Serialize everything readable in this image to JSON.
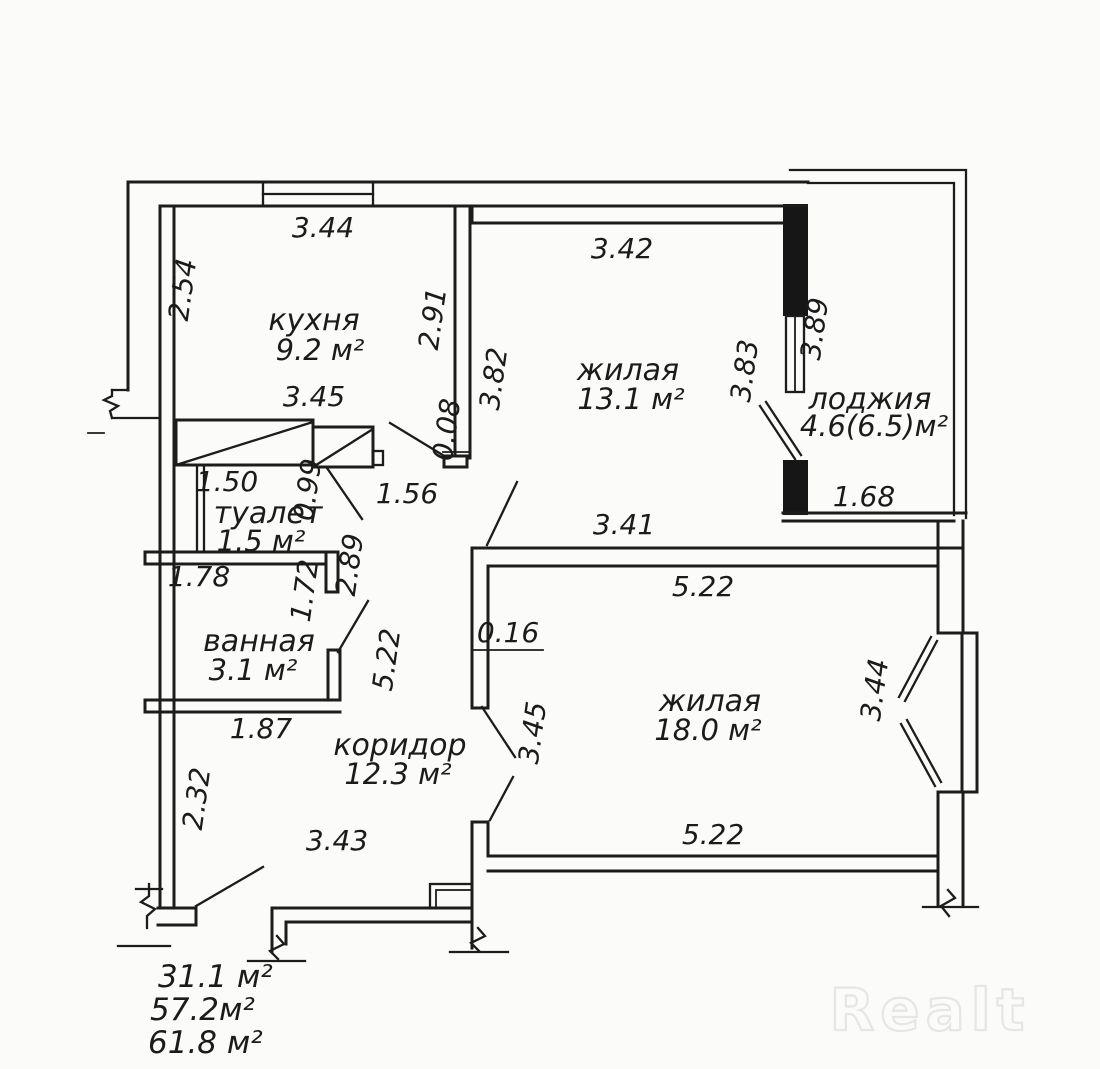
{
  "watermark": "Realt",
  "rooms": {
    "kitchen": {
      "name": "кухня",
      "area": "9.2 м²"
    },
    "living1": {
      "name": "жилая",
      "area": "13.1 м²"
    },
    "loggia": {
      "name": "лоджия",
      "area": "4.6(6.5)м²"
    },
    "toilet": {
      "name": "туалет",
      "area": "1.5 м²"
    },
    "bath": {
      "name": "ванная",
      "area": "3.1 м²"
    },
    "living2": {
      "name": "жилая",
      "area": "18.0 м²"
    },
    "corridor": {
      "name": "коридор",
      "area": "12.3 м²"
    }
  },
  "dimensions": {
    "kitchen_top": "3.44",
    "kitchen_left": "2.54",
    "kitchen_right": "2.91",
    "kitchen_bottom": "3.45",
    "living1_top": "3.42",
    "living1_left": "3.82",
    "living1_right": "3.83",
    "loggia_side": "3.89",
    "loggia_bottom": "1.68",
    "wall_gap": "0.08",
    "toilet_width": "1.50",
    "toilet_door": "0.99",
    "niche": "1.56",
    "toilet_depth": "2.89",
    "hall_gap": "3.41",
    "bath_top": "1.78",
    "bath_inner": "1.72",
    "living2_top": "5.22",
    "partition": "0.16",
    "corridor_depth": "5.22",
    "bay": "3.44",
    "living2_left": "3.45",
    "bath_bottom": "1.87",
    "corridor_left": "2.32",
    "corridor_bottom": "3.43",
    "living2_bottom": "5.22"
  },
  "totals": {
    "living_area": "31.1 м²",
    "apartment_area": "57.2м²",
    "total_area": "61.8 м²"
  },
  "line_color": "#1c1c1c",
  "background_color": "#fbfbfa"
}
